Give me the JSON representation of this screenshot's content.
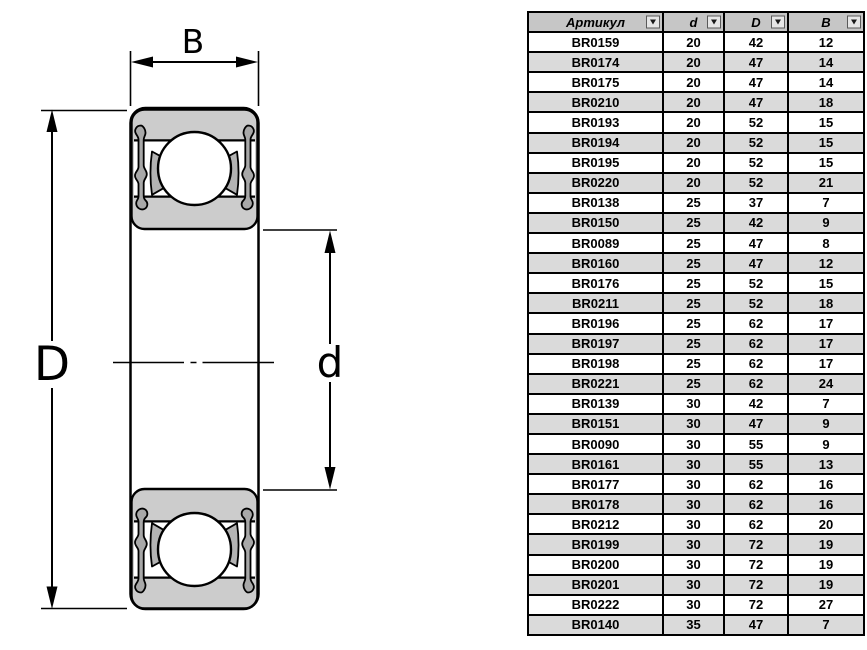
{
  "diagram": {
    "labels": {
      "width": "B",
      "outer_diameter": "D",
      "bore": "d"
    },
    "colors": {
      "ring_fill": "#cccccc",
      "seal_fill": "#a8a8a8",
      "wedge_fill": "#b3b3b3",
      "outline": "#000000"
    },
    "icons": {
      "filter_dropdown": "chevron-down"
    }
  },
  "table": {
    "columns": [
      {
        "key": "article",
        "label": "Артикул"
      },
      {
        "key": "d",
        "label": "d"
      },
      {
        "key": "D",
        "label": "D"
      },
      {
        "key": "B",
        "label": "B"
      }
    ],
    "rows": [
      [
        "BR0159",
        "20",
        "42",
        "12"
      ],
      [
        "BR0174",
        "20",
        "47",
        "14"
      ],
      [
        "BR0175",
        "20",
        "47",
        "14"
      ],
      [
        "BR0210",
        "20",
        "47",
        "18"
      ],
      [
        "BR0193",
        "20",
        "52",
        "15"
      ],
      [
        "BR0194",
        "20",
        "52",
        "15"
      ],
      [
        "BR0195",
        "20",
        "52",
        "15"
      ],
      [
        "BR0220",
        "20",
        "52",
        "21"
      ],
      [
        "BR0138",
        "25",
        "37",
        "7"
      ],
      [
        "BR0150",
        "25",
        "42",
        "9"
      ],
      [
        "BR0089",
        "25",
        "47",
        "8"
      ],
      [
        "BR0160",
        "25",
        "47",
        "12"
      ],
      [
        "BR0176",
        "25",
        "52",
        "15"
      ],
      [
        "BR0211",
        "25",
        "52",
        "18"
      ],
      [
        "BR0196",
        "25",
        "62",
        "17"
      ],
      [
        "BR0197",
        "25",
        "62",
        "17"
      ],
      [
        "BR0198",
        "25",
        "62",
        "17"
      ],
      [
        "BR0221",
        "25",
        "62",
        "24"
      ],
      [
        "BR0139",
        "30",
        "42",
        "7"
      ],
      [
        "BR0151",
        "30",
        "47",
        "9"
      ],
      [
        "BR0090",
        "30",
        "55",
        "9"
      ],
      [
        "BR0161",
        "30",
        "55",
        "13"
      ],
      [
        "BR0177",
        "30",
        "62",
        "16"
      ],
      [
        "BR0178",
        "30",
        "62",
        "16"
      ],
      [
        "BR0212",
        "30",
        "62",
        "20"
      ],
      [
        "BR0199",
        "30",
        "72",
        "19"
      ],
      [
        "BR0200",
        "30",
        "72",
        "19"
      ],
      [
        "BR0201",
        "30",
        "72",
        "19"
      ],
      [
        "BR0222",
        "30",
        "72",
        "27"
      ],
      [
        "BR0140",
        "35",
        "47",
        "7"
      ]
    ]
  }
}
